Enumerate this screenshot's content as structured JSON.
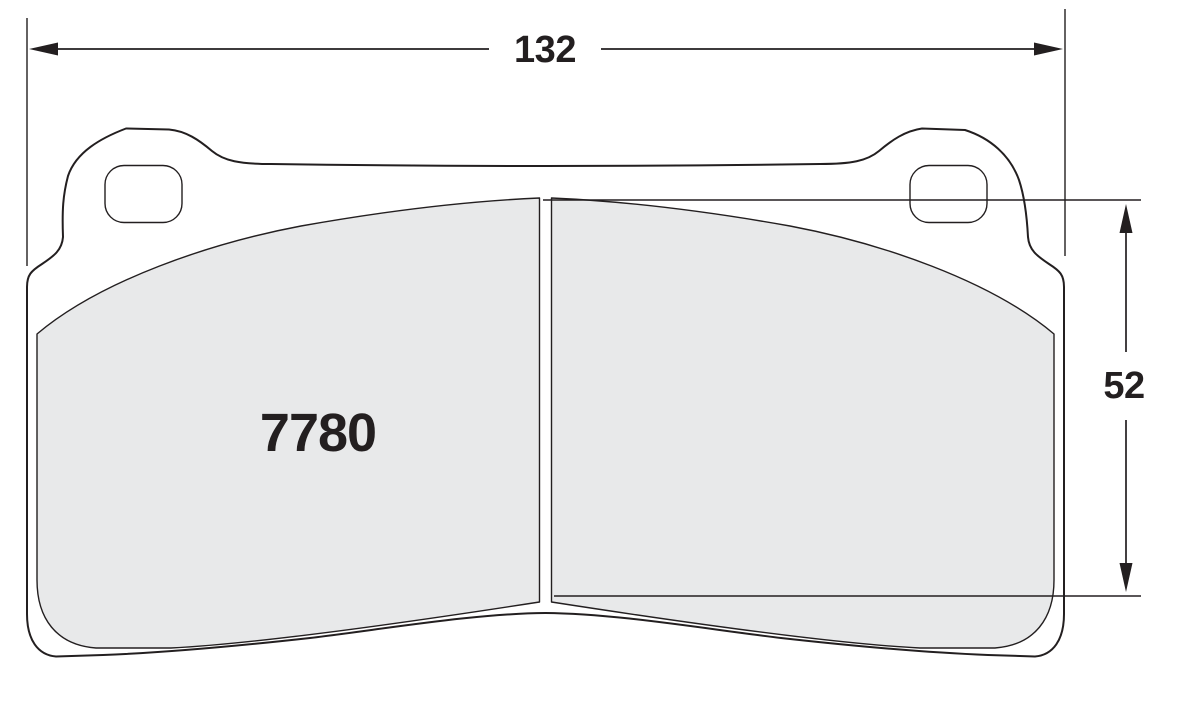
{
  "diagram": {
    "part_number": "7780",
    "dimensions": {
      "width": {
        "label": "132"
      },
      "height": {
        "label": "52"
      }
    },
    "colors": {
      "outline": "#231f20",
      "friction": "#e8e9ea",
      "background": "#ffffff"
    }
  }
}
